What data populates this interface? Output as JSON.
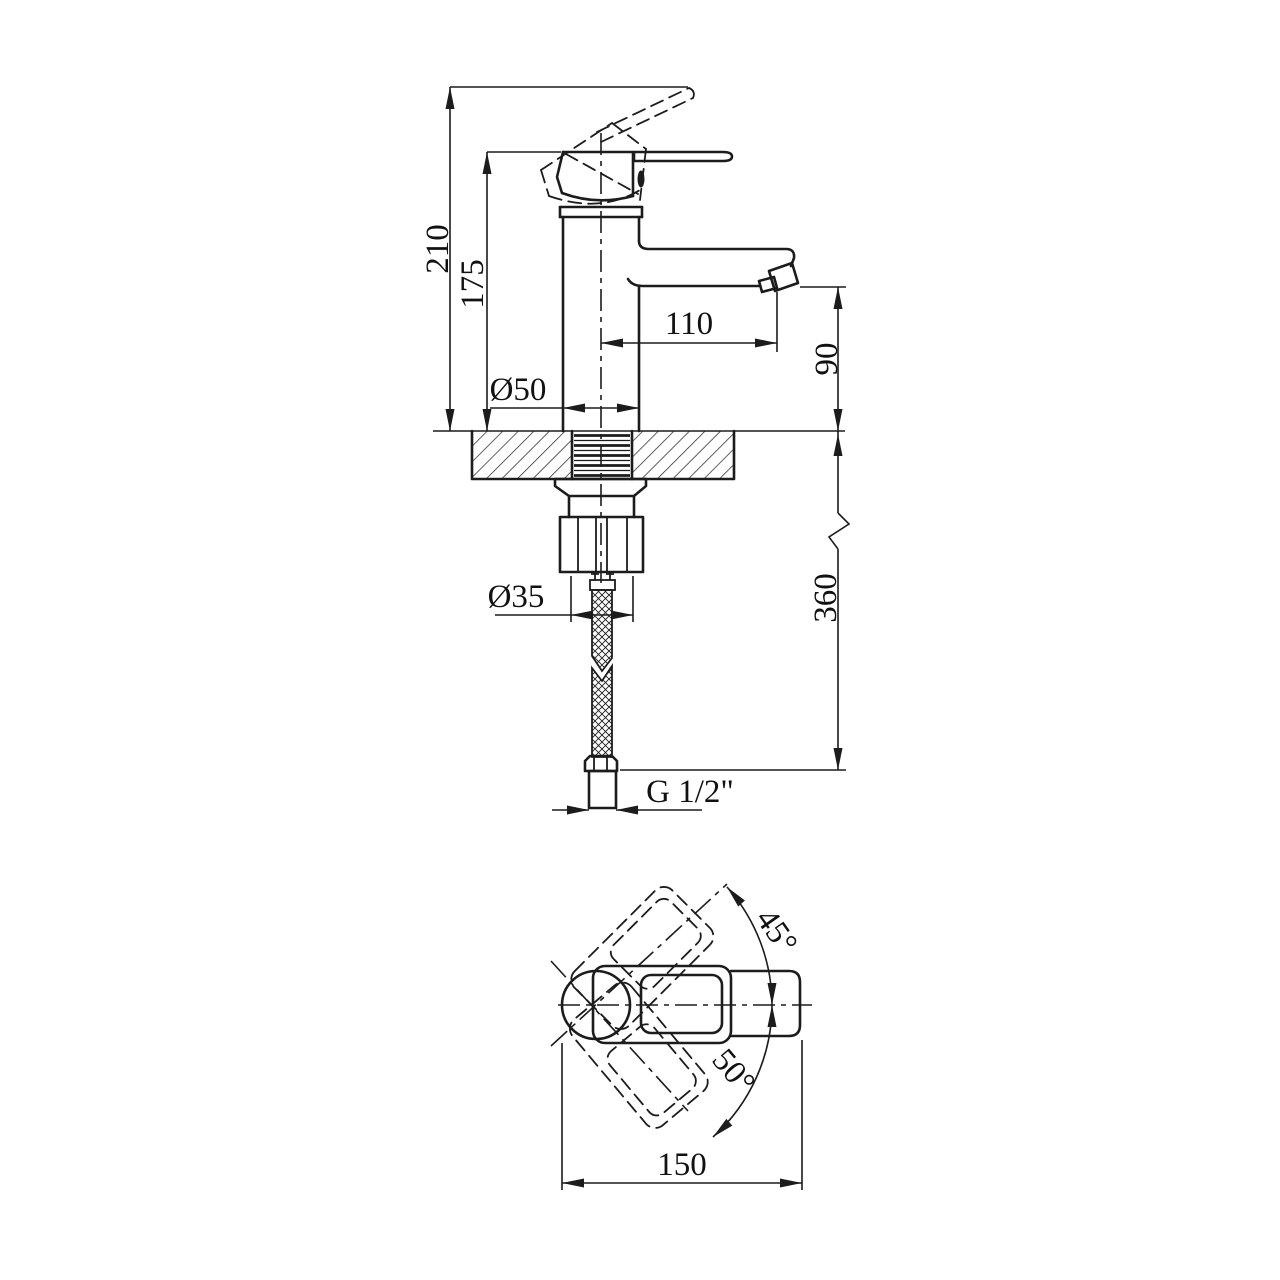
{
  "drawing": {
    "type": "faucet-technical-drawing",
    "views": {
      "side_view": "basin mixer side elevation with mounting hose",
      "top_view": "handle swing plan view"
    },
    "dims": {
      "overall_height": "210",
      "body_height": "175",
      "spout_reach": "110",
      "spout_height": "90",
      "body_diameter": "Ø50",
      "shank_diameter": "Ø35",
      "hose_length": "360",
      "thread_size": "G 1/2\"",
      "swing_up": "45°",
      "swing_down": "50°",
      "overall_width": "150"
    },
    "line_color": "#1c1c1c",
    "background": "#ffffff"
  }
}
